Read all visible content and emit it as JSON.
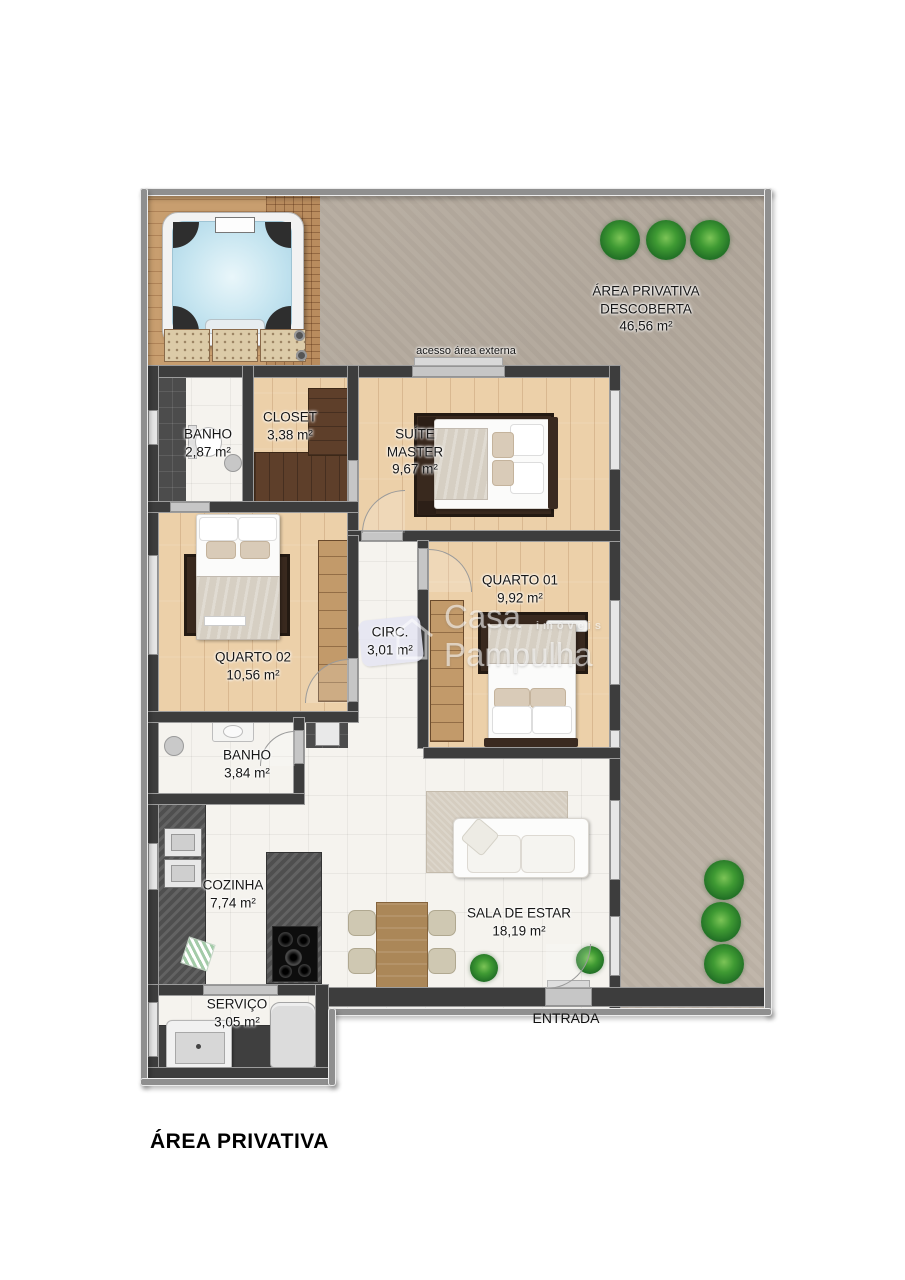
{
  "page_title": "ÁREA PRIVATIVA",
  "watermark": {
    "brand_line1": "Casa",
    "brand_line2": "Pampulha",
    "brand_sub": "imóveis"
  },
  "outdoor": {
    "label_line1": "ÁREA PRIVATIVA",
    "label_line2": "DESCOBERTA",
    "area": "46,56 m²",
    "access_label": "acesso área externa",
    "entrance_label": "ENTRADA"
  },
  "rooms": {
    "banho_suite": {
      "name": "BANHO",
      "area": "2,87 m²"
    },
    "closet": {
      "name": "CLOSET",
      "area": "3,38 m²"
    },
    "suite_master": {
      "name_line1": "SUÍTE",
      "name_line2": "MASTER",
      "area": "9,67 m²"
    },
    "quarto_01": {
      "name": "QUARTO 01",
      "area": "9,92 m²"
    },
    "quarto_02": {
      "name": "QUARTO 02",
      "area": "10,56 m²"
    },
    "circulacao": {
      "name": "CIRC.",
      "area": "3,01 m²"
    },
    "banho_social": {
      "name": "BANHO",
      "area": "3,84 m²"
    },
    "cozinha": {
      "name": "COZINHA",
      "area": "7,74 m²"
    },
    "sala_de_estar": {
      "name": "SALA DE ESTAR",
      "area": "18,19 m²"
    },
    "servico": {
      "name": "SERVIÇO",
      "area": "3,05 m²"
    }
  }
}
